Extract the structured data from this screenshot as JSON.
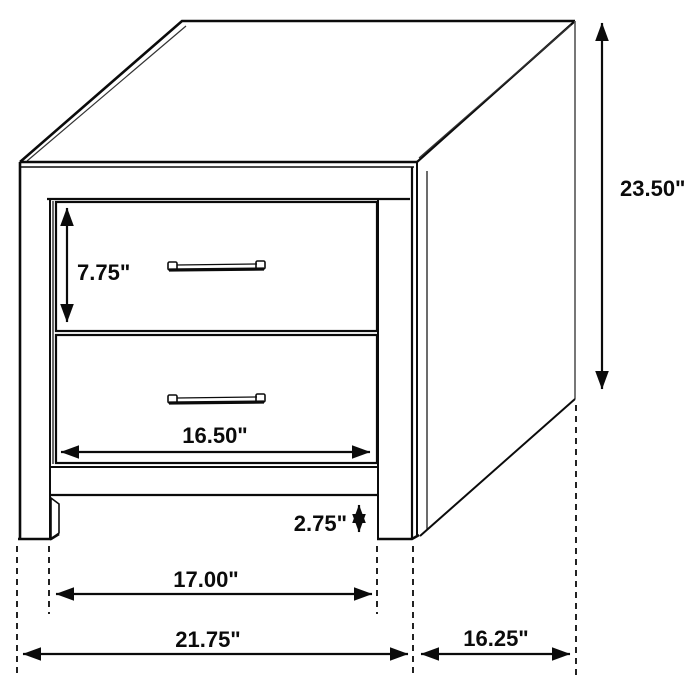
{
  "drawing": {
    "subject": "2-drawer nightstand dimension diagram",
    "line_color": "#0b0b0b",
    "background_color": "#ffffff"
  },
  "dimensions": {
    "overall_height": {
      "label": "23.50\""
    },
    "top_drawer_height": {
      "label": "7.75\""
    },
    "drawer_width": {
      "label": "16.50\""
    },
    "base_clearance": {
      "label": "2.75\""
    },
    "inner_leg_span": {
      "label": "17.00\""
    },
    "overall_width": {
      "label": "21.75\""
    },
    "side_depth": {
      "label": "16.25\""
    }
  }
}
